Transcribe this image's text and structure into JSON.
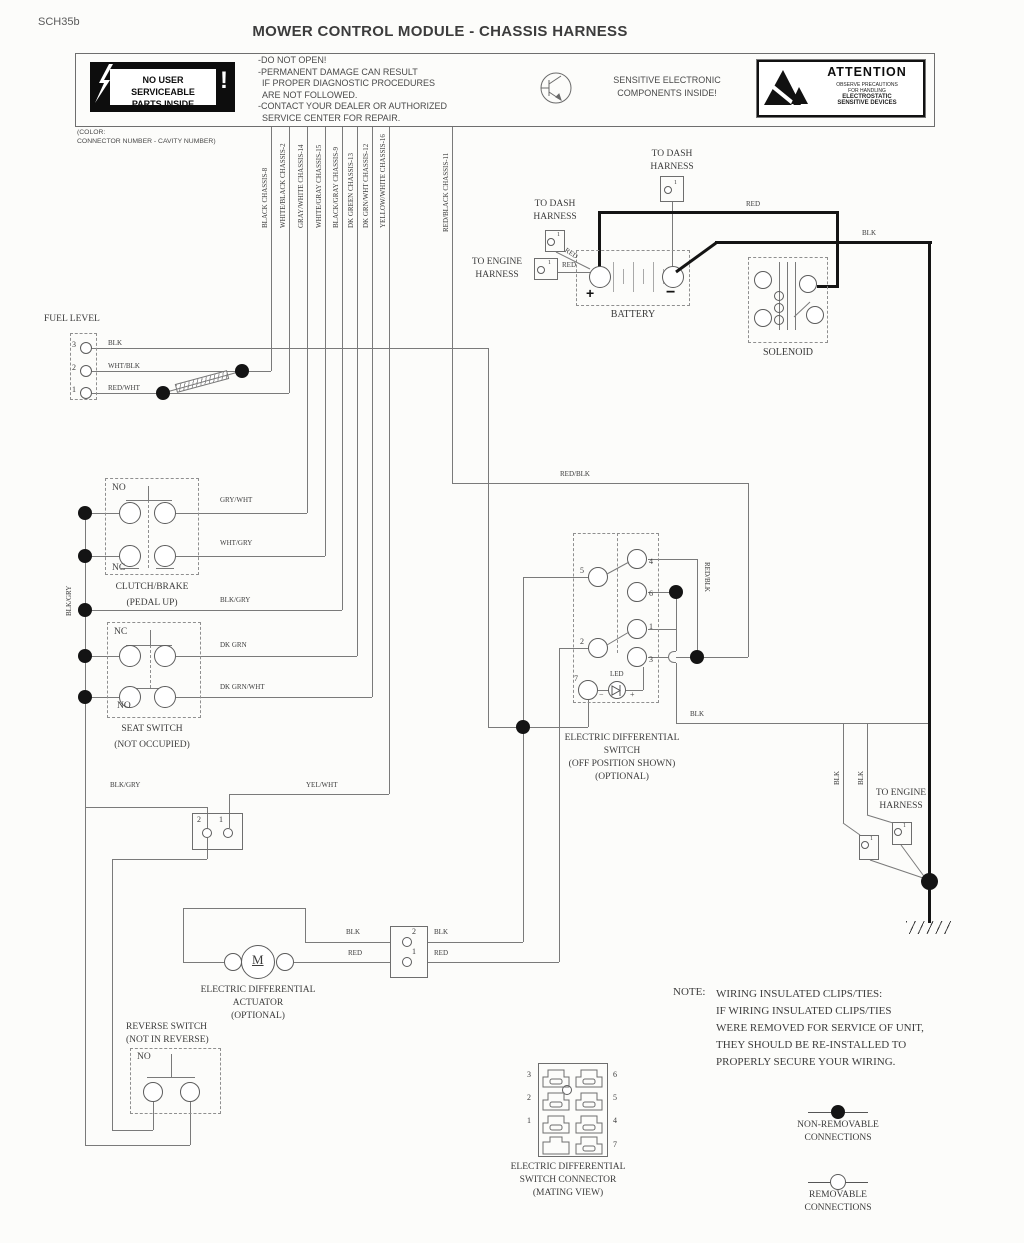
{
  "sheet_code": "SCH35b",
  "title": "MOWER CONTROL MODULE - CHASSIS HARNESS",
  "colors": {
    "wire": "#7a7a7a",
    "power_wire": "#141414",
    "text": "#3c3c3c"
  },
  "module": {
    "service_label": [
      "NO USER SERVICEABLE",
      "PARTS INSIDE"
    ],
    "bang": "!",
    "warnings": [
      "-DO NOT OPEN!",
      "-PERMANENT DAMAGE CAN RESULT",
      "IF PROPER DIAGNOSTIC PROCEDURES",
      "ARE NOT FOLLOWED.",
      "-CONTACT YOUR DEALER OR AUTHORIZED",
      "SERVICE CENTER FOR REPAIR."
    ],
    "sensitive": [
      "SENSITIVE ELECTRONIC",
      "COMPONENTS INSIDE!"
    ],
    "attention_title": "ATTENTION",
    "attention_lines": [
      "OBSERVE PRECAUTIONS",
      "FOR HANDLING",
      "ELECTROSTATIC",
      "SENSITIVE DEVICES"
    ],
    "color_note": [
      "(COLOR:",
      "CONNECTOR NUMBER - CAVITY NUMBER)"
    ]
  },
  "harness_wires": [
    "BLACK CHASSIS-8",
    "WHITE/BLACK CHASSIS-2",
    "GRAY/WHITE CHASSIS-14",
    "WHITE/GRAY CHASSIS-15",
    "BLACK/GRAY CHASSIS-9",
    "DK GREEN CHASSIS-13",
    "DK GRN/WHT CHASSIS-12",
    "YELLOW/WHITE CHASSIS-16",
    "RED/BLACK CHASSIS-11"
  ],
  "fuel": {
    "title": "FUEL LEVEL",
    "pins": [
      "3",
      "2",
      "1"
    ],
    "wires": [
      "BLK",
      "WHT/BLK",
      "RED/WHT"
    ]
  },
  "power": {
    "to_dash_top": [
      "TO DASH",
      "HARNESS"
    ],
    "to_dash_left": [
      "TO DASH",
      "HARNESS"
    ],
    "to_engine": [
      "TO ENGINE",
      "HARNESS"
    ],
    "pin1": "1",
    "battery": "BATTERY",
    "plus": "+",
    "minus": "−",
    "solenoid": "SOLENOID",
    "red_top": "RED",
    "blk_top": "BLK",
    "red_diag": "RED",
    "red_in": "RED"
  },
  "clutch": {
    "no": "NO",
    "nc": "NC",
    "name": [
      "CLUTCH/BRAKE",
      "(PEDAL UP)"
    ],
    "w_no": "GRY/WHT",
    "w_nc": "WHT/GRY",
    "w_rail": "BLK/GRY",
    "rail_side": "BLK/GRY"
  },
  "seat": {
    "nc": "NC",
    "no": "NO",
    "name": [
      "SEAT SWITCH",
      "(NOT OCCUPIED)"
    ],
    "w_nc": "DK GRN",
    "w_no": "DK GRN/WHT"
  },
  "lower_left": {
    "blkgry": "BLK/GRY",
    "yelwht": "YEL/WHT",
    "pin2": "2",
    "pin1": "1"
  },
  "diff": {
    "name": [
      "ELECTRIC DIFFERENTIAL",
      "SWITCH",
      "(OFF POSITION SHOWN)",
      "(OPTIONAL)"
    ],
    "p5": "5",
    "p4": "4",
    "p6": "6",
    "p2": "2",
    "p1": "1",
    "p3": "3",
    "p7": "7",
    "led": "LED",
    "minus": "−",
    "plus": "+",
    "redblk_h": "RED/BLK",
    "redblk_v": "RED/BLK",
    "blk": "BLK"
  },
  "actuator": {
    "name": [
      "ELECTRIC DIFFERENTIAL",
      "ACTUATOR",
      "(OPTIONAL)"
    ],
    "motor": "M",
    "blk_l": "BLK",
    "red_l": "RED",
    "blk_r": "BLK",
    "red_r": "RED",
    "pin2": "2",
    "pin1": "1"
  },
  "reverse": {
    "name": [
      "REVERSE SWITCH",
      "(NOT IN REVERSE)"
    ],
    "no": "NO"
  },
  "engine_br": {
    "name": [
      "TO ENGINE",
      "HARNESS"
    ],
    "blk_a": "BLK",
    "blk_b": "BLK",
    "pin_a": "1",
    "pin_b": "1"
  },
  "mating": {
    "name": [
      "ELECTRIC DIFFERENTIAL",
      "SWITCH CONNECTOR",
      "(MATING VIEW)"
    ],
    "left": [
      "3",
      "2",
      "1"
    ],
    "right": [
      "6",
      "5",
      "4",
      "7"
    ]
  },
  "note": {
    "prefix": "NOTE:",
    "lines": [
      "WIRING INSULATED CLIPS/TIES:",
      "IF WIRING INSULATED CLIPS/TIES",
      "WERE REMOVED FOR SERVICE OF UNIT,",
      "THEY SHOULD BE RE-INSTALLED TO",
      "PROPERLY SECURE YOUR WIRING."
    ]
  },
  "legend": {
    "non_removable": [
      "NON-REMOVABLE",
      "CONNECTIONS"
    ],
    "removable": [
      "REMOVABLE",
      "CONNECTIONS"
    ]
  }
}
